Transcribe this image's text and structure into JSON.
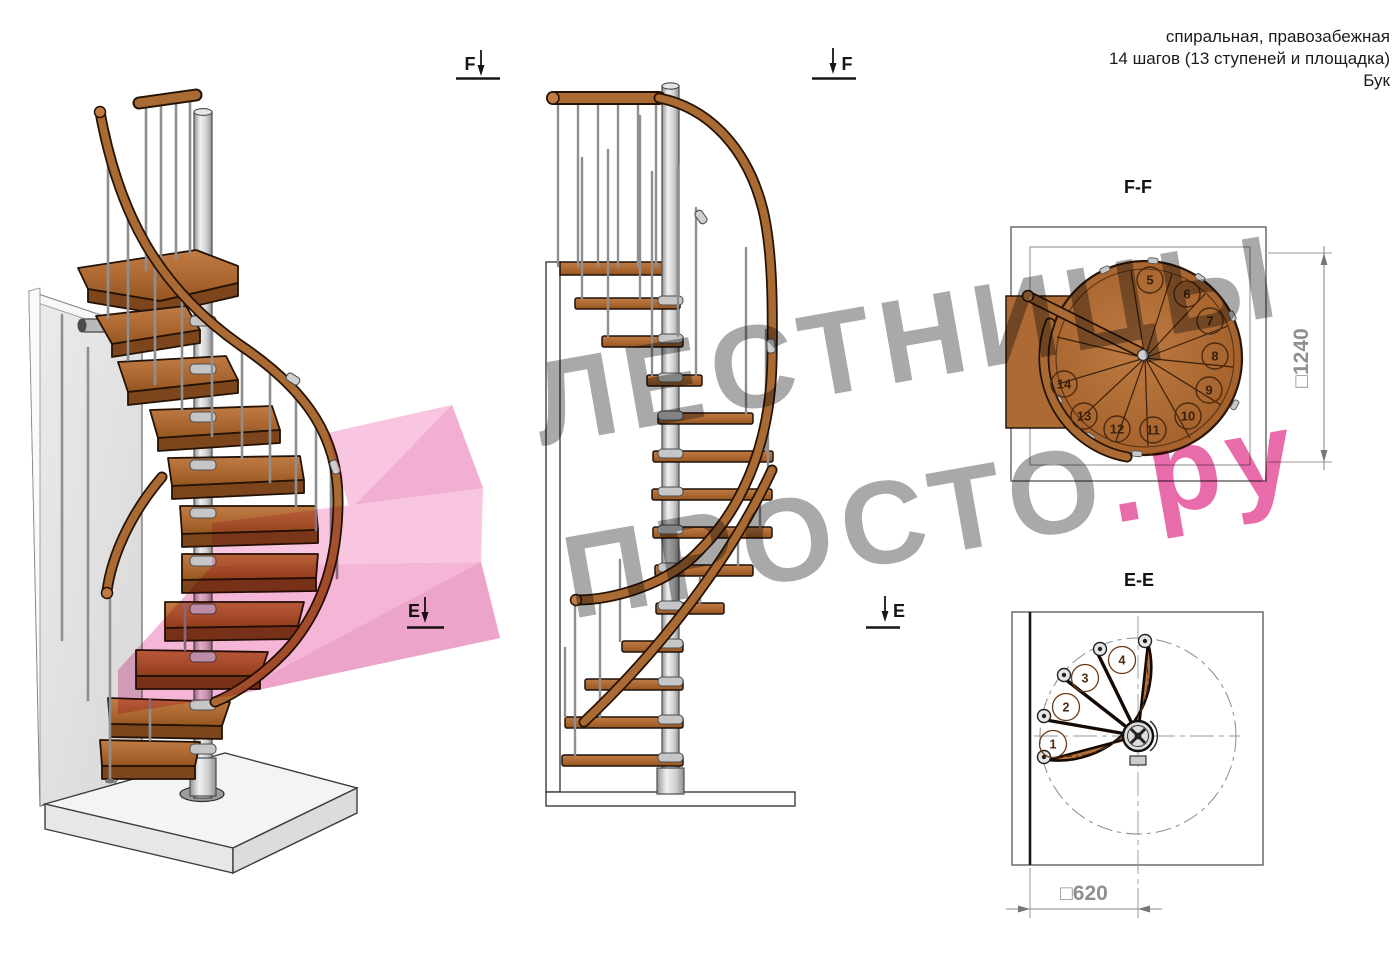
{
  "info": {
    "line1": "спиральная, правозабежная",
    "line2": "14 шагов (13 ступеней и площадка)",
    "line3": "Бук"
  },
  "watermark": {
    "line1": "ЛЕСТНИЦЫ",
    "line2_gray": "ПРОСТО",
    "line2_pink": ".ру"
  },
  "labels": {
    "ff_title": "F-F",
    "ee_title": "E-E",
    "f_marker": "F",
    "e_marker": "E"
  },
  "dimensions": {
    "ff": "□1240",
    "ee": "□620"
  },
  "ff_steps": [
    "5",
    "6",
    "7",
    "8",
    "9",
    "10",
    "11",
    "12",
    "13",
    "14"
  ],
  "ee_steps": [
    "1",
    "2",
    "3",
    "4"
  ],
  "colors": {
    "wood": "#ad6832",
    "wood_dark": "#7c451c",
    "metal": "#d9d9d9",
    "watermark_gray": "#8c8c8c",
    "watermark_pink": "#e23a8e",
    "arrow_pink": "#f4b3d5"
  }
}
